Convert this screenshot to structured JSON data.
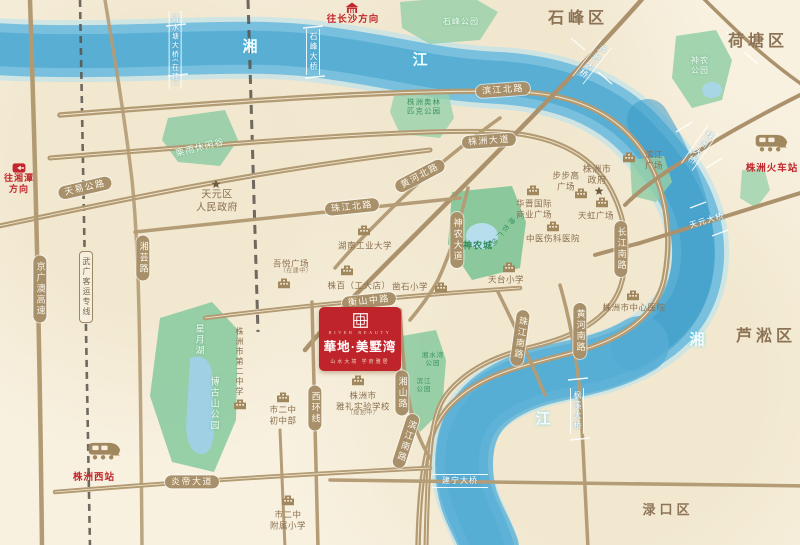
{
  "project": {
    "en": "RIVER BEAUTY",
    "title": "華地·美墅湾",
    "slogan": "山水大境  学府雅居",
    "accent_color": "#c0242b"
  },
  "map": {
    "colors": {
      "background": "#f8f1e0",
      "river": "#57abd0",
      "road": "#b29a73",
      "road_pill": "#a8906a",
      "park": "#8fcba4",
      "brown_text": "#8a6f50",
      "district_text": "#8d7355",
      "red_accent": "#c1272d"
    },
    "labels": [
      {
        "name": "road-label-tianyi",
        "text": "天易公路",
        "x": 85,
        "y": 188,
        "t": "road",
        "rot": -13
      },
      {
        "name": "road-label-jingguangao",
        "text": "京广澳高速",
        "x": 40,
        "y": 289,
        "t": "road v"
      },
      {
        "name": "rail-label-wuguang",
        "text": "武广客运专线",
        "x": 86,
        "y": 287,
        "t": "rail v"
      },
      {
        "name": "road-label-xiangyun",
        "text": "湘芸路",
        "x": 143,
        "y": 258,
        "t": "road v"
      },
      {
        "name": "road-label-binjiangbei",
        "text": "滨江北路",
        "x": 503,
        "y": 90,
        "t": "road",
        "rot": -4
      },
      {
        "name": "road-label-zhuzhoudadao",
        "text": "株洲大道",
        "x": 489,
        "y": 141,
        "t": "road",
        "rot": -4
      },
      {
        "name": "road-label-huanghebei",
        "text": "黄河北路",
        "x": 420,
        "y": 176,
        "t": "road",
        "rot": -28
      },
      {
        "name": "road-label-zhujiangbei",
        "text": "珠江北路",
        "x": 352,
        "y": 207,
        "t": "road",
        "rot": -6
      },
      {
        "name": "road-label-hengshan",
        "text": "衡山中路",
        "x": 369,
        "y": 301,
        "t": "road",
        "rot": -6
      },
      {
        "name": "road-label-shennongdadao",
        "text": "神农大道",
        "x": 457,
        "y": 240,
        "t": "road v"
      },
      {
        "name": "road-label-zhujiangnan",
        "text": "珠江南路",
        "x": 520,
        "y": 338,
        "t": "road v",
        "rot": 8
      },
      {
        "name": "road-label-huanghenan",
        "text": "黄河南路",
        "x": 580,
        "y": 331,
        "t": "road v"
      },
      {
        "name": "road-label-changjiangnan",
        "text": "长江南路",
        "x": 621,
        "y": 249,
        "t": "road v"
      },
      {
        "name": "road-label-xihuan",
        "text": "西环线",
        "x": 315,
        "y": 408,
        "t": "road v"
      },
      {
        "name": "road-label-xiangshan",
        "text": "湘山路",
        "x": 402,
        "y": 393,
        "t": "road v"
      },
      {
        "name": "road-label-binjiangnan",
        "text": "滨江南路",
        "x": 406,
        "y": 441,
        "t": "road v",
        "rot": 18
      },
      {
        "name": "road-label-yandi",
        "text": "炎帝大道",
        "x": 192,
        "y": 482,
        "t": "road"
      },
      {
        "name": "bridge-label-qingshuitang",
        "text": "清水塘大桥(在建)",
        "x": 175,
        "y": 50,
        "t": "bridge v",
        "fs": 7
      },
      {
        "name": "bridge-label-shifeng",
        "text": "石峰大桥",
        "x": 313,
        "y": 52,
        "t": "bridge v"
      },
      {
        "name": "bridge-label-lusong",
        "text": "芦淞大桥",
        "x": 592,
        "y": 62,
        "t": "bridge v",
        "rot": 38
      },
      {
        "name": "bridge-label-zhuzhou",
        "text": "株洲大桥",
        "x": 700,
        "y": 148,
        "t": "bridge v",
        "rot": 35
      },
      {
        "name": "bridge-label-tianyuan",
        "text": "天元大桥",
        "x": 707,
        "y": 221,
        "t": "bridge",
        "rot": -17
      },
      {
        "name": "bridge-label-fengxi",
        "text": "枫溪大桥",
        "x": 577,
        "y": 411,
        "t": "bridge v"
      },
      {
        "name": "bridge-label-jianning",
        "text": "建宁大桥",
        "x": 460,
        "y": 481,
        "t": "bridge bh"
      },
      {
        "name": "river-label-xiang-north",
        "text": "湘",
        "x": 250,
        "y": 48,
        "t": "river"
      },
      {
        "name": "river-label-jiang-north",
        "text": "江",
        "x": 420,
        "y": 61,
        "t": "river"
      },
      {
        "name": "river-label-xiang-east",
        "text": "湘",
        "x": 697,
        "y": 341,
        "t": "river"
      },
      {
        "name": "river-label-jiang-south",
        "text": "江",
        "x": 543,
        "y": 420,
        "t": "river"
      },
      {
        "name": "district-label-shifeng",
        "text": "石峰区",
        "x": 578,
        "y": 19,
        "t": "district"
      },
      {
        "name": "district-label-hetang",
        "text": "荷塘区",
        "x": 758,
        "y": 42,
        "t": "district"
      },
      {
        "name": "district-label-lusong",
        "text": "芦淞区",
        "x": 766,
        "y": 337,
        "t": "district"
      },
      {
        "name": "district-label-lukou",
        "text": "渌口区",
        "x": 668,
        "y": 510,
        "t": "district",
        "fs": 13
      },
      {
        "name": "poi-label-tianyuan-gov",
        "lines": [
          "天元区",
          "人民政府"
        ],
        "x": 217,
        "y": 202,
        "t": "poi",
        "fs": 10
      },
      {
        "name": "poi-label-zhuzhou-gov",
        "lines": [
          "株洲市",
          "政府"
        ],
        "x": 597,
        "y": 175,
        "t": "poi",
        "fs": 9
      },
      {
        "name": "park-label-shifengpark",
        "text": "石峰公园",
        "x": 461,
        "y": 22,
        "t": "park pale"
      },
      {
        "name": "park-label-liyu",
        "text": "栗雨休闲谷",
        "x": 200,
        "y": 148,
        "t": "park pale",
        "rot": -14,
        "fs": 9
      },
      {
        "name": "park-label-olympic",
        "lines": [
          "株洲奥林",
          "匹克公园"
        ],
        "x": 424,
        "y": 107,
        "t": "park",
        "fs": 7.5
      },
      {
        "name": "park-label-shennongpark",
        "lines": [
          "神农",
          "公园"
        ],
        "x": 700,
        "y": 66,
        "t": "park pale"
      },
      {
        "name": "park-label-shennongcheng",
        "text": "神农城",
        "x": 478,
        "y": 246,
        "t": "park dark",
        "fs": 9
      },
      {
        "name": "park-label-shennongsq",
        "text": "神农广场",
        "x": 502,
        "y": 232,
        "t": "park v",
        "rot": 40,
        "fs": 7
      },
      {
        "name": "park-label-xingyue",
        "text": "星月湖",
        "x": 199,
        "y": 340,
        "t": "park pale v",
        "fs": 9
      },
      {
        "name": "park-label-bogushan",
        "text": "博古山公园",
        "x": 214,
        "y": 404,
        "t": "park pale v",
        "fs": 9
      },
      {
        "name": "park-label-xiangshuiwan",
        "lines": [
          "湘水湾",
          "公园"
        ],
        "x": 433,
        "y": 360,
        "t": "park",
        "fs": 6.5
      },
      {
        "name": "park-label-binjiangpark",
        "lines": [
          "滨江",
          "公园"
        ],
        "x": 424,
        "y": 386,
        "t": "park",
        "fs": 6.5
      },
      {
        "name": "poi-label-hnut",
        "text": "湖南工业大学",
        "x": 365,
        "y": 246,
        "t": "poi"
      },
      {
        "name": "poi-label-wuyue",
        "text": "吾悦广场",
        "x": 291,
        "y": 264,
        "t": "poi"
      },
      {
        "name": "poi-label-wuyue-note",
        "text": "（在建中）",
        "x": 296,
        "y": 272,
        "t": "poi tiny"
      },
      {
        "name": "poi-label-zhubai",
        "text": "株百（工大店）",
        "x": 359,
        "y": 286,
        "t": "poi"
      },
      {
        "name": "poi-label-zaoshi",
        "text": "凿石小学",
        "x": 410,
        "y": 287,
        "t": "poi"
      },
      {
        "name": "poi-label-huajin",
        "lines": [
          "华晋国际",
          "商业广场"
        ],
        "x": 534,
        "y": 209,
        "t": "poi"
      },
      {
        "name": "poi-label-bubugao",
        "lines": [
          "步步高",
          "广场"
        ],
        "x": 566,
        "y": 181,
        "t": "poi"
      },
      {
        "name": "poi-label-tianhong",
        "text": "天虹广场",
        "x": 596,
        "y": 216,
        "t": "poi"
      },
      {
        "name": "poi-label-zhongyi",
        "text": "中医伤科医院",
        "x": 553,
        "y": 239,
        "t": "poi"
      },
      {
        "name": "poi-label-center-hospital",
        "text": "株洲市中心医院",
        "x": 634,
        "y": 308,
        "t": "poi"
      },
      {
        "name": "poi-label-binjiangsq",
        "lines": [
          "滨江",
          "广场"
        ],
        "x": 654,
        "y": 160,
        "t": "poi"
      },
      {
        "name": "poi-label-tiantai",
        "text": "天台小学",
        "x": 506,
        "y": 280,
        "t": "poi"
      },
      {
        "name": "poi-label-yali",
        "lines": [
          "株洲市",
          "雅礼实验学校"
        ],
        "x": 363,
        "y": 401,
        "t": "poi"
      },
      {
        "name": "poi-label-yali-note",
        "text": "（规划中）",
        "x": 363,
        "y": 414,
        "t": "poi tiny"
      },
      {
        "name": "poi-label-no2",
        "text": "株洲市第二中学",
        "x": 239,
        "y": 362,
        "t": "poi v",
        "fs": 8
      },
      {
        "name": "poi-label-no2junior",
        "lines": [
          "市二中",
          "初中部"
        ],
        "x": 283,
        "y": 415,
        "t": "poi"
      },
      {
        "name": "poi-label-no2primary",
        "lines": [
          "市二中",
          "附属小学"
        ],
        "x": 288,
        "y": 520,
        "t": "poi"
      },
      {
        "name": "poi-label-changsha",
        "text": "往长沙方向",
        "x": 353,
        "y": 21,
        "t": "red"
      },
      {
        "name": "poi-label-xiangtan",
        "lines": [
          "往湘潭",
          "方向"
        ],
        "x": 19,
        "y": 184,
        "t": "red",
        "fs": 9
      },
      {
        "name": "poi-label-station",
        "text": "株洲火车站",
        "x": 772,
        "y": 170,
        "t": "red"
      },
      {
        "name": "poi-label-west-station",
        "text": "株洲西站",
        "x": 94,
        "y": 479,
        "t": "red"
      }
    ],
    "icons": [
      {
        "name": "building-icon-hnut",
        "kind": "building",
        "x": 364,
        "y": 230
      },
      {
        "name": "building-icon-wuyue",
        "kind": "building",
        "x": 284,
        "y": 283
      },
      {
        "name": "building-icon-zhubai",
        "kind": "building",
        "x": 347,
        "y": 270
      },
      {
        "name": "building-icon-zaoshi",
        "kind": "building",
        "x": 441,
        "y": 287
      },
      {
        "name": "building-icon-huajin",
        "kind": "building",
        "x": 533,
        "y": 190
      },
      {
        "name": "building-icon-bubugao",
        "kind": "building",
        "x": 581,
        "y": 193
      },
      {
        "name": "building-icon-tianhong",
        "kind": "building",
        "x": 602,
        "y": 202
      },
      {
        "name": "building-icon-zhongyi",
        "kind": "building",
        "x": 553,
        "y": 226
      },
      {
        "name": "building-icon-center-hospital",
        "kind": "building",
        "x": 633,
        "y": 295
      },
      {
        "name": "building-icon-binjiangsq",
        "kind": "building",
        "x": 629,
        "y": 157
      },
      {
        "name": "building-icon-tiantai",
        "kind": "building",
        "x": 509,
        "y": 267
      },
      {
        "name": "building-icon-yali",
        "kind": "building",
        "x": 358,
        "y": 380
      },
      {
        "name": "building-icon-no2",
        "kind": "building",
        "x": 240,
        "y": 404
      },
      {
        "name": "building-icon-no2junior",
        "kind": "building",
        "x": 283,
        "y": 397
      },
      {
        "name": "building-icon-no2primary",
        "kind": "building",
        "x": 288,
        "y": 500
      },
      {
        "name": "star-icon-tianyuan-gov",
        "kind": "star",
        "x": 216,
        "y": 184
      },
      {
        "name": "star-icon-zhuzhou-gov",
        "kind": "star",
        "x": 599,
        "y": 191
      },
      {
        "name": "train-icon-station",
        "kind": "train",
        "x": 771,
        "y": 143
      },
      {
        "name": "train-icon-west-station",
        "kind": "train",
        "x": 104,
        "y": 451
      },
      {
        "name": "red-building-icon-changsha",
        "kind": "redhouse",
        "x": 352,
        "y": 8
      },
      {
        "name": "red-arrow-icon-xiangtan",
        "kind": "redarrow",
        "x": 19,
        "y": 168
      }
    ]
  }
}
